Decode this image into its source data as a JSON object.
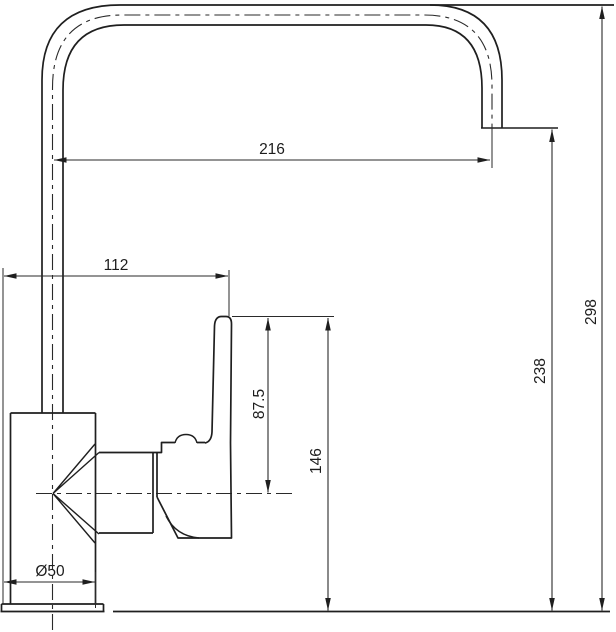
{
  "drawing": {
    "title": "kitchen faucet side-view dimensional drawing",
    "units": "mm",
    "background_color": "#ffffff",
    "line_color": "#1f1f1f",
    "dimensions": {
      "spout_reach": {
        "label": "216"
      },
      "base_to_handle": {
        "label": "112"
      },
      "handle_to_centerline": {
        "label": "87.5"
      },
      "handle_top_height": {
        "label": "146"
      },
      "outlet_height": {
        "label": "238"
      },
      "overall_height": {
        "label": "298"
      },
      "base_diameter": {
        "label": "Ø50"
      }
    }
  }
}
